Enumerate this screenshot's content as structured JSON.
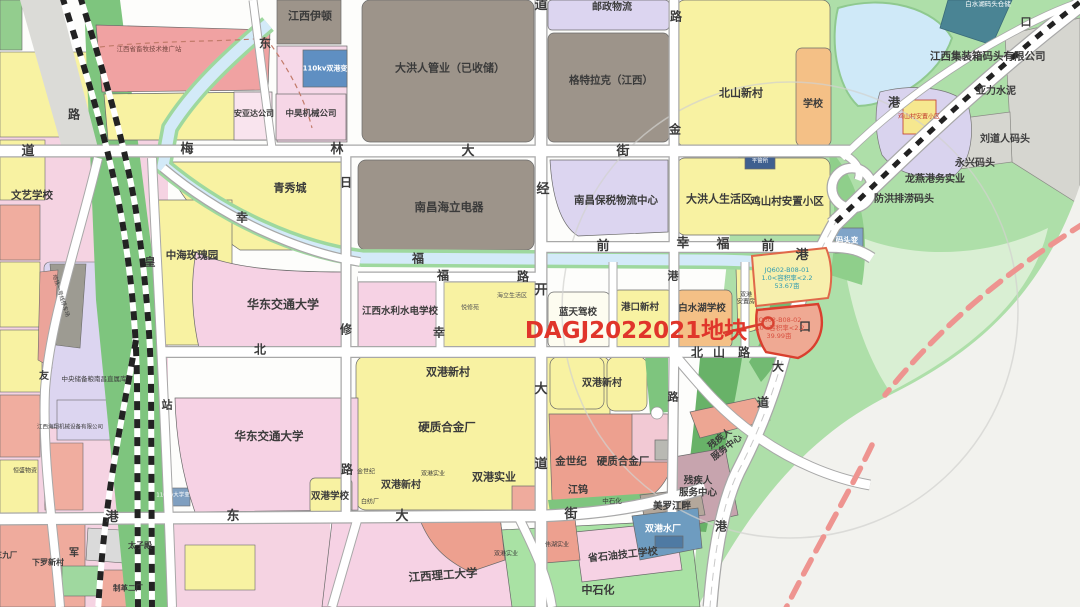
{
  "map_title": "DAGJ2022021地块区位示意图",
  "palette": {
    "highlight_red": "#e0352b",
    "parcel_outline_red": "#d93f2e",
    "jq01_text_color": "#2e9ab0",
    "jq02_text_color": "#d8503f",
    "residential_yellow": "#f8f2a2",
    "school_pink": "#f6d2e4",
    "industry_salmon": "#efab9d",
    "storage_grey": "#9d948a",
    "logistics_lavender": "#dcd5f0",
    "green_space": "#7ec57e",
    "water_blue": "#cfe8f6",
    "utility_blue": "#6e9cc0"
  },
  "highlight": {
    "plot_id_text": "DAGJ2022021地块",
    "parcel1": {
      "code": "JQ602-B08-01",
      "far": "1.0<容积率<2.2",
      "area": "53.67亩"
    },
    "parcel2": {
      "code": "JQ602-B08-02",
      "far": "1.0<容积率<2.2",
      "area": "39.99亩"
    }
  },
  "labels": [
    {
      "id": "road-dao-w",
      "text": "道",
      "x": 28,
      "y": 152,
      "size": 13
    },
    {
      "id": "road-mei",
      "text": "梅",
      "x": 187,
      "y": 150,
      "size": 13
    },
    {
      "id": "road-lin",
      "text": "林",
      "x": 337,
      "y": 150,
      "size": 13
    },
    {
      "id": "road-da-n",
      "text": "大",
      "x": 468,
      "y": 152,
      "size": 13
    },
    {
      "id": "road-jie-n",
      "text": "街",
      "x": 623,
      "y": 152,
      "size": 13
    },
    {
      "id": "road-dong-nw",
      "text": "东",
      "x": 265,
      "y": 44,
      "size": 12
    },
    {
      "id": "road-lu-nw",
      "text": "路",
      "x": 74,
      "y": 115,
      "size": 12
    },
    {
      "id": "road-lu-jin",
      "text": "路",
      "x": 676,
      "y": 17,
      "size": 12
    },
    {
      "id": "road-jin",
      "text": "金",
      "x": 675,
      "y": 130,
      "size": 12
    },
    {
      "id": "road-dao-top",
      "text": "道",
      "x": 541,
      "y": 6,
      "size": 13
    },
    {
      "id": "road-jing",
      "text": "经",
      "x": 543,
      "y": 190,
      "size": 13
    },
    {
      "id": "road-kai",
      "text": "开",
      "x": 541,
      "y": 291,
      "size": 13
    },
    {
      "id": "road-da-c",
      "text": "大",
      "x": 541,
      "y": 390,
      "size": 13
    },
    {
      "id": "road-dao-c",
      "text": "道",
      "x": 541,
      "y": 465,
      "size": 13
    },
    {
      "id": "road-ri",
      "text": "日",
      "x": 346,
      "y": 183,
      "size": 12
    },
    {
      "id": "road-xiu",
      "text": "修",
      "x": 346,
      "y": 330,
      "size": 12
    },
    {
      "id": "road-lu-xiu",
      "text": "路",
      "x": 347,
      "y": 470,
      "size": 12
    },
    {
      "id": "road-xing-nw",
      "text": "幸",
      "x": 242,
      "y": 218,
      "size": 12
    },
    {
      "id": "road-fu-stream",
      "text": "福",
      "x": 418,
      "y": 259,
      "size": 12
    },
    {
      "id": "road-fu-b",
      "text": "福",
      "x": 443,
      "y": 276,
      "size": 12
    },
    {
      "id": "road-lu-b",
      "text": "路",
      "x": 523,
      "y": 277,
      "size": 12
    },
    {
      "id": "road-xing-v",
      "text": "幸",
      "x": 439,
      "y": 333,
      "size": 12
    },
    {
      "id": "road-bei-w",
      "text": "北",
      "x": 260,
      "y": 350,
      "size": 12
    },
    {
      "id": "road-qian1",
      "text": "前",
      "x": 603,
      "y": 247,
      "size": 13
    },
    {
      "id": "road-xing-e",
      "text": "幸",
      "x": 683,
      "y": 244,
      "size": 13
    },
    {
      "id": "road-fu-e",
      "text": "福",
      "x": 723,
      "y": 245,
      "size": 13
    },
    {
      "id": "road-qian2",
      "text": "前",
      "x": 768,
      "y": 247,
      "size": 13
    },
    {
      "id": "road-gang-e",
      "text": "港",
      "x": 802,
      "y": 256,
      "size": 13
    },
    {
      "id": "road-gang-v",
      "text": "港",
      "x": 673,
      "y": 276,
      "size": 11
    },
    {
      "id": "road-bei-shan",
      "text": "北",
      "x": 697,
      "y": 353,
      "size": 12
    },
    {
      "id": "road-shan",
      "text": "山",
      "x": 719,
      "y": 353,
      "size": 12
    },
    {
      "id": "road-lu-shan",
      "text": "路",
      "x": 744,
      "y": 353,
      "size": 12
    },
    {
      "id": "road-kou",
      "text": "口",
      "x": 805,
      "y": 327,
      "size": 12
    },
    {
      "id": "road-da-gk",
      "text": "大",
      "x": 778,
      "y": 367,
      "size": 12
    },
    {
      "id": "road-dao-gk",
      "text": "道",
      "x": 763,
      "y": 403,
      "size": 12
    },
    {
      "id": "road-lu-s",
      "text": "路",
      "x": 673,
      "y": 397,
      "size": 11
    },
    {
      "id": "road-gang-sw",
      "text": "港",
      "x": 112,
      "y": 518,
      "size": 13
    },
    {
      "id": "road-dong-s",
      "text": "东",
      "x": 233,
      "y": 517,
      "size": 13
    },
    {
      "id": "road-da-s",
      "text": "大",
      "x": 402,
      "y": 517,
      "size": 13
    },
    {
      "id": "road-jie-s",
      "text": "街",
      "x": 571,
      "y": 515,
      "size": 13
    },
    {
      "id": "road-gang-se",
      "text": "港",
      "x": 721,
      "y": 527,
      "size": 12
    },
    {
      "id": "road-gang-ne",
      "text": "港",
      "x": 894,
      "y": 103,
      "size": 12
    },
    {
      "id": "road-kou-ne",
      "text": "口",
      "x": 1026,
      "y": 22,
      "size": 11
    },
    {
      "id": "road-huang",
      "text": "皇",
      "x": 150,
      "y": 262,
      "size": 11
    },
    {
      "id": "road-zhan",
      "text": "站",
      "x": 167,
      "y": 405,
      "size": 11
    },
    {
      "id": "road-jun",
      "text": "军",
      "x": 74,
      "y": 554,
      "size": 10
    },
    {
      "id": "road-you",
      "text": "友",
      "x": 44,
      "y": 377,
      "size": 10
    },
    {
      "id": "area-jiangxi-yidun",
      "text": "江西伊顿",
      "x": 310,
      "y": 16,
      "size": 11
    },
    {
      "id": "area-xumu-station",
      "text": "江西省畜牧技术推广站",
      "x": 149,
      "y": 50,
      "size": 6.5,
      "weight": 400,
      "color": "#7a4a44"
    },
    {
      "id": "area-shuanggang-substation",
      "text": "110kv双港变",
      "x": 325,
      "y": 69,
      "size": 7,
      "color": "#ffffff",
      "weight": 600
    },
    {
      "id": "area-anyada",
      "text": "安亚达公司",
      "x": 254,
      "y": 114,
      "size": 8
    },
    {
      "id": "area-zhonghao-machinery",
      "text": "中昊机械公司",
      "x": 311,
      "y": 114,
      "size": 8.5
    },
    {
      "id": "area-youzheng-wuliu",
      "text": "邮政物流",
      "x": 612,
      "y": 8,
      "size": 10
    },
    {
      "id": "area-dahongren-guanye",
      "text": "大洪人管业（已收储）",
      "x": 450,
      "y": 68,
      "size": 11
    },
    {
      "id": "area-getrag",
      "text": "格特拉克（江西）",
      "x": 611,
      "y": 81,
      "size": 10.5
    },
    {
      "id": "area-beishan-xincun",
      "text": "北山新村",
      "x": 741,
      "y": 93,
      "size": 11
    },
    {
      "id": "area-xuexiao",
      "text": "学校",
      "x": 813,
      "y": 105,
      "size": 10
    },
    {
      "id": "area-baishuihu-wharf",
      "text": "白水湖码头仓储",
      "x": 988,
      "y": 5,
      "size": 6.5,
      "color": "#ffffff",
      "weight": 500
    },
    {
      "id": "area-container-wharf",
      "text": "江西集装箱码头有限公司",
      "x": 930,
      "y": 57,
      "size": 10.5,
      "align": "left"
    },
    {
      "id": "area-yali-cement",
      "text": "亚力水泥",
      "x": 996,
      "y": 92,
      "size": 10
    },
    {
      "id": "area-liudaoren-wharf",
      "text": "刘道人码头",
      "x": 1005,
      "y": 140,
      "size": 10
    },
    {
      "id": "area-yongxing-wharf",
      "text": "永兴码头",
      "x": 975,
      "y": 164,
      "size": 10
    },
    {
      "id": "area-longyan-port",
      "text": "龙燕港务实业",
      "x": 935,
      "y": 180,
      "size": 10
    },
    {
      "id": "area-fanghong-wharf",
      "text": "防洪排涝码头",
      "x": 904,
      "y": 200,
      "size": 10
    },
    {
      "id": "area-matou-substation",
      "text": "码头变",
      "x": 847,
      "y": 240,
      "size": 7.5,
      "color": "#ffffff",
      "weight": 600
    },
    {
      "id": "area-jishancun-small",
      "text": "鸡山村安置小区",
      "x": 919,
      "y": 117,
      "size": 6,
      "color": "#c0392b",
      "weight": 500
    },
    {
      "id": "area-wenyi-school",
      "text": "文艺学校",
      "x": 32,
      "y": 196,
      "size": 10.5
    },
    {
      "id": "area-qingxiucheng",
      "text": "青秀城",
      "x": 290,
      "y": 188,
      "size": 11
    },
    {
      "id": "area-zhonghai-rose",
      "text": "中海玫瑰园",
      "x": 192,
      "y": 256,
      "size": 10.5
    },
    {
      "id": "area-huadong-jiaotong-n",
      "text": "华东交通大学",
      "x": 283,
      "y": 305,
      "size": 12
    },
    {
      "id": "area-shuili-school",
      "text": "江西水利水电学校",
      "x": 400,
      "y": 312,
      "size": 9.5
    },
    {
      "id": "area-haili-shenghuoqu",
      "text": "海立生活区",
      "x": 512,
      "y": 296,
      "size": 6,
      "weight": 400,
      "color": "#555555"
    },
    {
      "id": "area-yuexiuyuan",
      "text": "悦修苑",
      "x": 470,
      "y": 308,
      "size": 6,
      "weight": 400,
      "color": "#555555"
    },
    {
      "id": "area-haili-electric",
      "text": "南昌海立电器",
      "x": 449,
      "y": 207,
      "size": 11.5
    },
    {
      "id": "area-baoshui-center",
      "text": "南昌保税物流中心",
      "x": 616,
      "y": 201,
      "size": 10.5
    },
    {
      "id": "area-dahongren-life",
      "text": "大洪人生活区",
      "x": 719,
      "y": 199,
      "size": 11
    },
    {
      "id": "area-jishancun-anzhi",
      "text": "鸡山村安置小区",
      "x": 787,
      "y": 202,
      "size": 10.5
    },
    {
      "id": "area-pingguansuo",
      "text": "平管所",
      "x": 760,
      "y": 162,
      "size": 5.5,
      "color": "#ffffff",
      "weight": 400
    },
    {
      "id": "area-lantian-driving",
      "text": "蓝天驾校",
      "x": 578,
      "y": 313,
      "size": 9.5
    },
    {
      "id": "area-gangkou-xincun",
      "text": "港口新村",
      "x": 640,
      "y": 308,
      "size": 9.5
    },
    {
      "id": "area-baishuihu-school",
      "text": "白水湖学校",
      "x": 702,
      "y": 309,
      "size": 9.5
    },
    {
      "id": "plot-id",
      "text": "DAGJ2022021地块",
      "x": 636,
      "y": 331,
      "size": 23,
      "color": "#e0352b",
      "weight": 800
    },
    {
      "id": "parcel-jq01-text",
      "text": "JQ602-B08-01\n1.0<容积率<2.2\n53.67亩",
      "x": 787,
      "y": 279,
      "size": 6.5,
      "color": "#2e9ab0",
      "weight": 500
    },
    {
      "id": "parcel-jq02-text",
      "text": "JQ602-B08-02\n1.0<容积率<2.2\n39.99亩",
      "x": 779,
      "y": 329,
      "size": 6.5,
      "color": "#d8503f",
      "weight": 500
    },
    {
      "id": "area-shuanggang-anzhifang",
      "text": "双港\n安置房",
      "x": 746,
      "y": 299,
      "size": 6,
      "weight": 400
    },
    {
      "id": "area-shuanggang-xincun-1",
      "text": "双港新村",
      "x": 448,
      "y": 372,
      "size": 11
    },
    {
      "id": "area-yingzhi-hejin-1",
      "text": "硬质合金厂",
      "x": 447,
      "y": 427,
      "size": 11.5
    },
    {
      "id": "area-shuanggang-shiye-1",
      "text": "双港实业",
      "x": 494,
      "y": 477,
      "size": 11
    },
    {
      "id": "area-shuanggang-xincun-2",
      "text": "双港新村",
      "x": 401,
      "y": 486,
      "size": 10
    },
    {
      "id": "area-jinshiji-tiny",
      "text": "金世纪",
      "x": 366,
      "y": 472,
      "size": 6,
      "weight": 400
    },
    {
      "id": "area-shuanggang-shiye-tiny",
      "text": "双港实业",
      "x": 433,
      "y": 474,
      "size": 6,
      "weight": 400
    },
    {
      "id": "area-baifangchang-tiny",
      "text": "白纺厂",
      "x": 370,
      "y": 502,
      "size": 6,
      "weight": 400
    },
    {
      "id": "area-shuanggang-xincun-3",
      "text": "双港新村",
      "x": 602,
      "y": 384,
      "size": 10
    },
    {
      "id": "area-jinshiji",
      "text": "金世纪",
      "x": 571,
      "y": 462,
      "size": 10.5
    },
    {
      "id": "area-yingzhi-hejin-2",
      "text": "硬质合金厂",
      "x": 623,
      "y": 462,
      "size": 10.5
    },
    {
      "id": "area-jiangwu",
      "text": "江钨",
      "x": 578,
      "y": 491,
      "size": 10
    },
    {
      "id": "area-zhongshihua-tiny",
      "text": "中石化",
      "x": 612,
      "y": 502,
      "size": 6.5,
      "weight": 400
    },
    {
      "id": "area-meiluo-jiangpan",
      "text": "美罗江畔",
      "x": 672,
      "y": 507,
      "size": 9.5
    },
    {
      "id": "area-canjiren-center-diag",
      "text": "残疾人\n服务中心",
      "x": 724,
      "y": 444,
      "size": 9,
      "rotate": -38
    },
    {
      "id": "area-canjiren-center",
      "text": "残疾人\n服务中心",
      "x": 698,
      "y": 487,
      "size": 9.5
    },
    {
      "id": "area-shuanggang-waterworks",
      "text": "双港水厂",
      "x": 663,
      "y": 530,
      "size": 9,
      "color": "#ffffff",
      "weight": 600
    },
    {
      "id": "area-shiyou-school",
      "text": "省石油技工学校",
      "x": 623,
      "y": 556,
      "size": 10,
      "rotate": -6
    },
    {
      "id": "area-zhongshihua",
      "text": "中石化",
      "x": 598,
      "y": 590,
      "size": 11
    },
    {
      "id": "area-ligong-university",
      "text": "江西理工大学",
      "x": 443,
      "y": 575,
      "size": 11.5,
      "rotate": -4
    },
    {
      "id": "area-shuanggang-shiye-small",
      "text": "双港实业",
      "x": 506,
      "y": 554,
      "size": 6,
      "weight": 400
    },
    {
      "id": "area-weihu-shiye",
      "text": "伟湖实业",
      "x": 557,
      "y": 545,
      "size": 6,
      "weight": 400
    },
    {
      "id": "area-huadong-jiaotong-s",
      "text": "华东交通大学",
      "x": 269,
      "y": 436,
      "size": 11.5
    },
    {
      "id": "area-shuanggang-school",
      "text": "双港学校",
      "x": 330,
      "y": 497,
      "size": 9.5
    },
    {
      "id": "area-grain-depot",
      "text": "中央储备粮南昌直属库",
      "x": 94,
      "y": 380,
      "size": 6.5,
      "weight": 500
    },
    {
      "id": "area-xialuo-xincun",
      "text": "下罗新村",
      "x": 48,
      "y": 563,
      "size": 8
    },
    {
      "id": "area-taizidian",
      "text": "太子殿",
      "x": 140,
      "y": 546,
      "size": 8
    },
    {
      "id": "area-zhige-erchang",
      "text": "制革二厂",
      "x": 128,
      "y": 588,
      "size": 7.5
    },
    {
      "id": "area-sanjiuchang",
      "text": "三九厂",
      "x": 6,
      "y": 555,
      "size": 7.5
    },
    {
      "id": "area-haixiang-machinery",
      "text": "江西海翔机械设备有限公司",
      "x": 70,
      "y": 428,
      "size": 5.5,
      "weight": 400
    },
    {
      "id": "area-hengsheng-wuzi",
      "text": "恒盛物资",
      "x": 25,
      "y": 471,
      "size": 6,
      "weight": 400
    },
    {
      "id": "area-daxue-substation",
      "text": "110kv大学变",
      "x": 173,
      "y": 496,
      "size": 5.5,
      "color": "#ffffff",
      "weight": 500
    },
    {
      "id": "area-metro-depot",
      "text": "地铁一号线停车场",
      "x": 60,
      "y": 296,
      "size": 5.5,
      "weight": 400,
      "rotate": 72
    }
  ]
}
